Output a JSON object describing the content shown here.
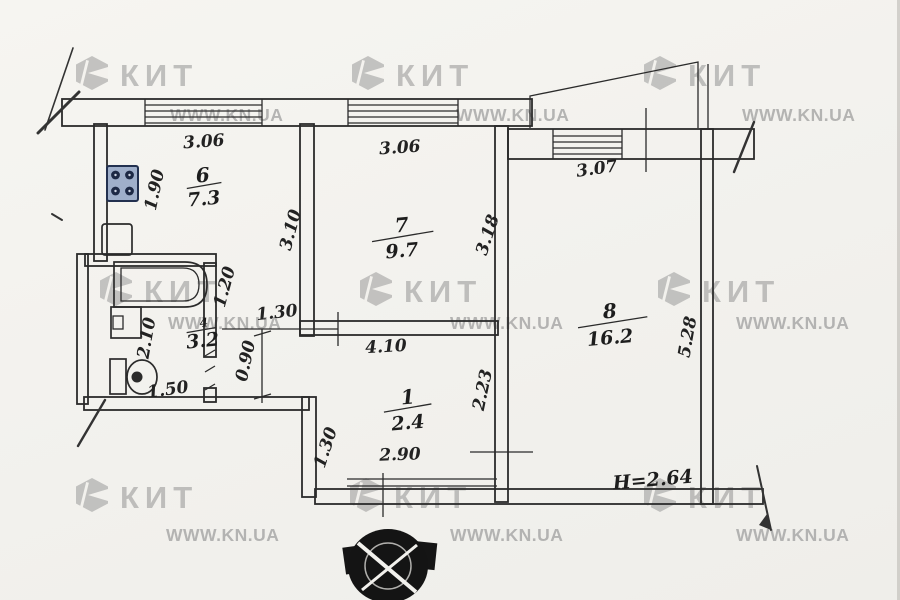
{
  "watermark": {
    "brand": "КИТ",
    "site": "WWW.KN.UA"
  },
  "plan": {
    "height_note": "H=2.64",
    "rooms": [
      {
        "name": "kitchen",
        "number": "6",
        "area": "7.3"
      },
      {
        "name": "living-room",
        "number": "7",
        "area": "9.7"
      },
      {
        "name": "bedroom",
        "number": "8",
        "area": "16.2"
      },
      {
        "name": "hallway",
        "number": "1",
        "area": "2.4"
      },
      {
        "name": "bathroom",
        "number": "4",
        "area": "3.2"
      }
    ],
    "dimensions": [
      {
        "id": "kitchen-window",
        "value": "3.06"
      },
      {
        "id": "room7-window",
        "value": "3.06"
      },
      {
        "id": "room8-window",
        "value": "3.07"
      },
      {
        "id": "kitchen-width",
        "value": "1.90"
      },
      {
        "id": "kitchen-depth",
        "value": "3.10"
      },
      {
        "id": "room7-depth",
        "value": "3.18"
      },
      {
        "id": "bathroom-depth",
        "value": "2.10"
      },
      {
        "id": "bathroom-top-width",
        "value": "1.20"
      },
      {
        "id": "corridor-width",
        "value": "1.30"
      },
      {
        "id": "corridor-depth",
        "value": "0.90"
      },
      {
        "id": "bathroom-width",
        "value": "1.50"
      },
      {
        "id": "hall-top-width",
        "value": "4.10"
      },
      {
        "id": "hall-depth",
        "value": "2.23"
      },
      {
        "id": "hall-bottom-width",
        "value": "2.90"
      },
      {
        "id": "entry-step",
        "value": "1.30"
      },
      {
        "id": "room8-depth",
        "value": "5.28"
      }
    ]
  }
}
